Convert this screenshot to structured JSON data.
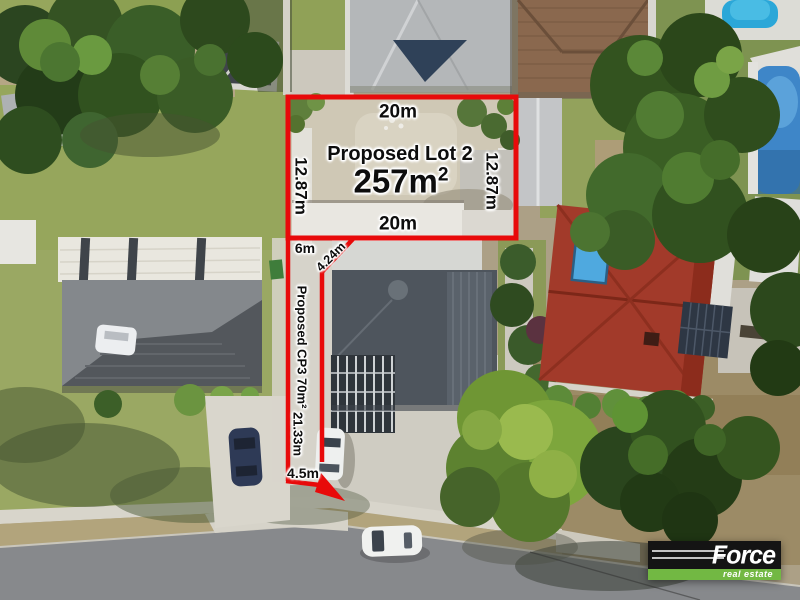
{
  "annotations": {
    "line_color": "#e80a0a",
    "lot": {
      "title": "Proposed Lot 2",
      "area_value": "257m",
      "area_sup": "2",
      "top_dim": "20m",
      "bottom_dim": "20m",
      "left_dim": "12.87m",
      "right_dim": "12.87m"
    },
    "corridor": {
      "top_dim": "6m",
      "splay_dim": "4.24m",
      "name": "Proposed CP3 70m²",
      "length_dim": "21.33m",
      "bottom_dim": "4.5m"
    }
  },
  "logo": {
    "brand": "Force",
    "tagline": "real estate",
    "colors": {
      "background": "#141414",
      "bar": "#72b843",
      "text": "#ffffff"
    }
  }
}
